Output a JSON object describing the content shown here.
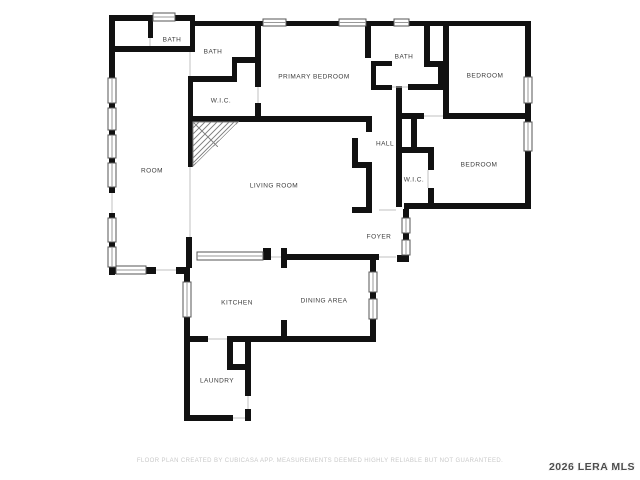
{
  "plan": {
    "title": "single-story residential floor plan",
    "wall_color": "#111111",
    "background_color": "#ffffff",
    "rooms": [
      {
        "id": "bath-upper-left",
        "label": "BATH"
      },
      {
        "id": "bath-middle",
        "label": "BATH"
      },
      {
        "id": "primary-bedroom",
        "label": "PRIMARY BEDROOM"
      },
      {
        "id": "bath-right",
        "label": "BATH"
      },
      {
        "id": "bedroom-top-right",
        "label": "BEDROOM"
      },
      {
        "id": "wic-left",
        "label": "W.I.C."
      },
      {
        "id": "room",
        "label": "ROOM"
      },
      {
        "id": "hall",
        "label": "HALL"
      },
      {
        "id": "living-room",
        "label": "LIVING ROOM"
      },
      {
        "id": "wic-right",
        "label": "W.I.C."
      },
      {
        "id": "bedroom-right",
        "label": "BEDROOM"
      },
      {
        "id": "foyer",
        "label": "FOYER"
      },
      {
        "id": "kitchen",
        "label": "KITCHEN"
      },
      {
        "id": "dining-area",
        "label": "DINING AREA"
      },
      {
        "id": "laundry",
        "label": "LAUNDRY"
      }
    ]
  },
  "footer": {
    "disclaimer": "FLOOR PLAN CREATED BY CUBICASA APP. MEASUREMENTS DEEMED HIGHLY RELIABLE BUT NOT GUARANTEED."
  },
  "watermark": {
    "text": "2026 LERA MLS"
  }
}
